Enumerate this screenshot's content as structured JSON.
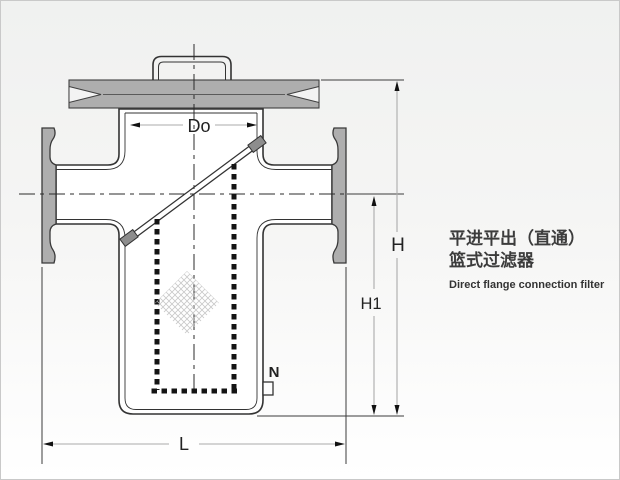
{
  "title_block": {
    "line1_zh": "平进平出（直通）",
    "line2_zh": "篮式过滤器",
    "line3_en": "Direct flange connection filter"
  },
  "labels": {
    "basket_diameter": "Do",
    "overall_height": "H",
    "body_height": "H1",
    "face_to_face_length": "L",
    "drain_connection": "N"
  },
  "colors": {
    "flange_gray": "#aeaeae",
    "clamp_gray": "#8d8d8d",
    "line_dark": "#333333",
    "dim_line_gray": "#ababab",
    "background_top": "#f0f1f0",
    "background_bottom": "#ffffff",
    "border": "#c9c9c9"
  }
}
